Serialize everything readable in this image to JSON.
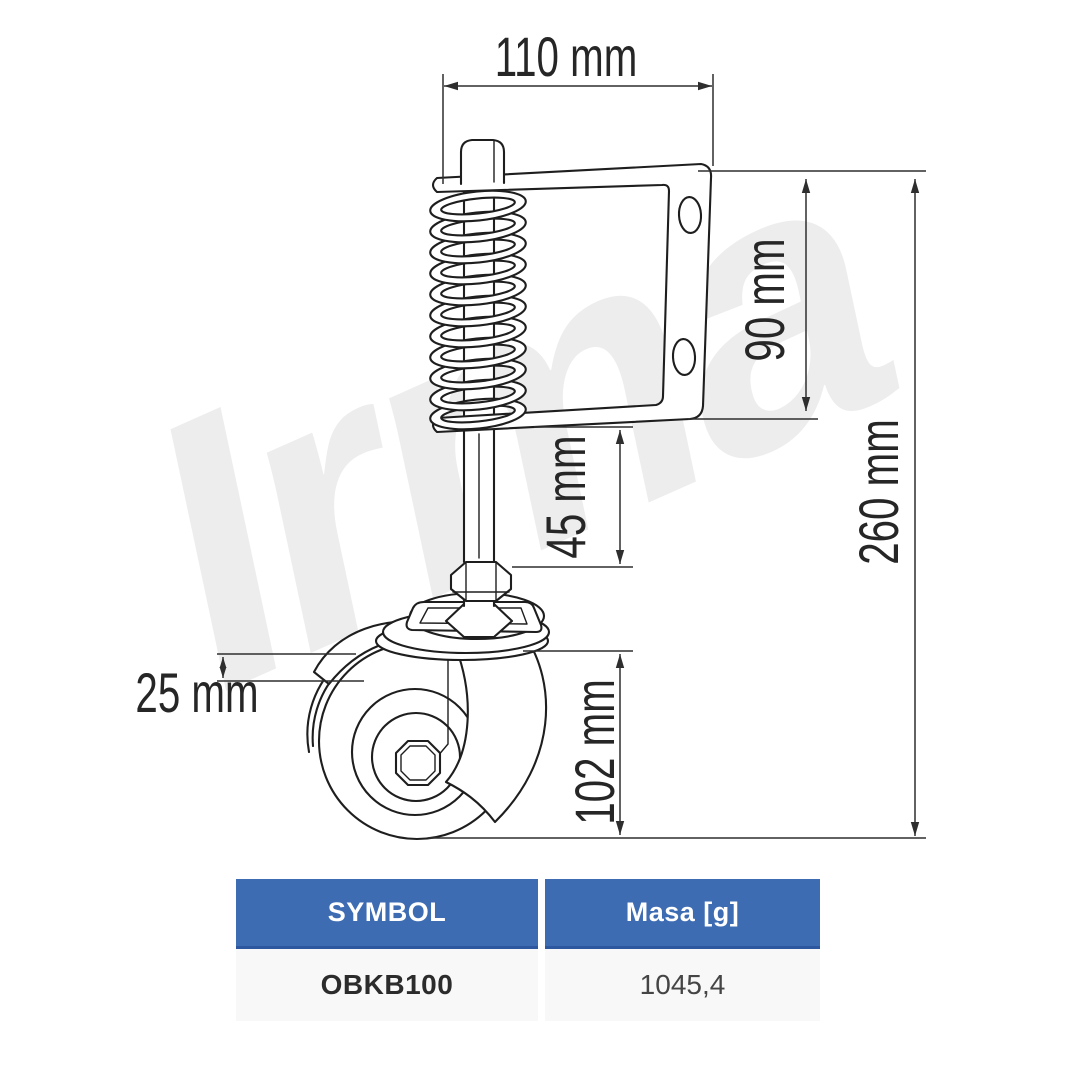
{
  "watermark": {
    "text": "Irma",
    "color": "#ededed"
  },
  "diagram": {
    "description": "spring-loaded-gate-caster-technical-drawing",
    "dim_width": "110 mm",
    "dim_bracket_height": "90 mm",
    "dim_total_height": "260 mm",
    "dim_stem": "45 mm",
    "dim_offset": "25 mm",
    "dim_wheel": "102 mm"
  },
  "spec_table": {
    "columns": [
      {
        "label": "SYMBOL"
      },
      {
        "label": "Masa [g]"
      }
    ],
    "rows": [
      {
        "symbol": "OBKB100",
        "mass": "1045,4"
      }
    ]
  },
  "colors": {
    "line": "#1e1e1e",
    "dimension": "#2e2e2e",
    "header_blue": "#3e6cb3",
    "header_border_blue": "#2d579e",
    "body_row_bg": "#f8f8f9",
    "watermark_gray": "#ededed"
  }
}
